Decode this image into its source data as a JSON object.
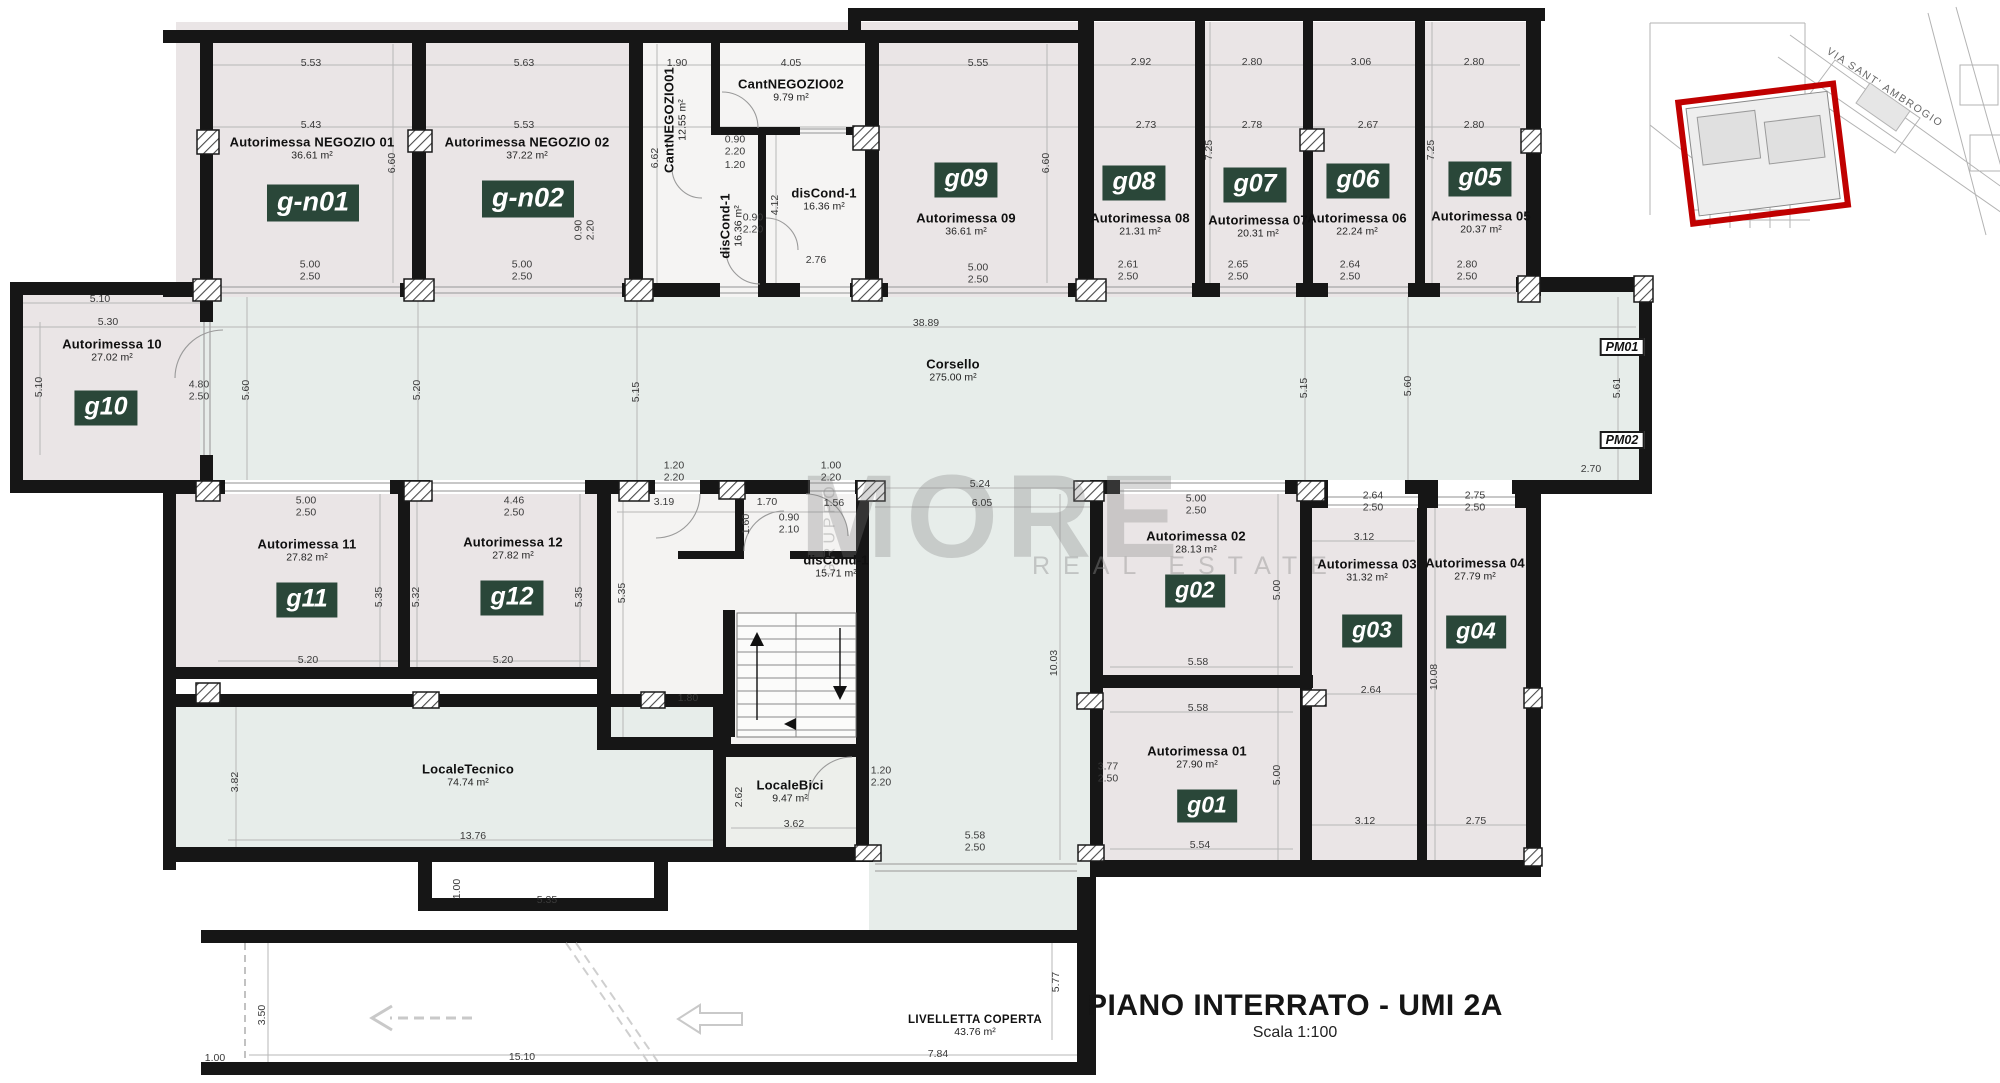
{
  "meta": {
    "title": "PIANO INTERRATO - UMI 2A",
    "scale_label": "Scala 1:100"
  },
  "watermark": {
    "brand": "MORE",
    "sub": "REAL ESTATE",
    "side": "GRUPPO"
  },
  "inset_map": {
    "street_label": "VIA SANT' AMBROGIO"
  },
  "pm_labels": [
    {
      "t": "PM01",
      "x": 1622,
      "y": 347
    },
    {
      "t": "PM02",
      "x": 1622,
      "y": 440
    }
  ],
  "badges": [
    {
      "t": "g-n01",
      "x": 313,
      "y": 203,
      "fs": 27
    },
    {
      "t": "g-n02",
      "x": 528,
      "y": 199,
      "fs": 27
    },
    {
      "t": "g09",
      "x": 966,
      "y": 180,
      "fs": 25
    },
    {
      "t": "g08",
      "x": 1134,
      "y": 183,
      "fs": 25
    },
    {
      "t": "g07",
      "x": 1255,
      "y": 185,
      "fs": 25
    },
    {
      "t": "g06",
      "x": 1358,
      "y": 181,
      "fs": 25
    },
    {
      "t": "g05",
      "x": 1480,
      "y": 179,
      "fs": 25
    },
    {
      "t": "g10",
      "x": 106,
      "y": 408,
      "fs": 25
    },
    {
      "t": "g11",
      "x": 307,
      "y": 600,
      "fs": 25
    },
    {
      "t": "g12",
      "x": 512,
      "y": 598,
      "fs": 25
    },
    {
      "t": "g02",
      "x": 1195,
      "y": 591,
      "fs": 23
    },
    {
      "t": "g03",
      "x": 1372,
      "y": 631,
      "fs": 23
    },
    {
      "t": "g04",
      "x": 1476,
      "y": 632,
      "fs": 23
    },
    {
      "t": "g01",
      "x": 1207,
      "y": 806,
      "fs": 23
    }
  ],
  "rooms": [
    {
      "n": "Autorimessa NEGOZIO 01",
      "a": "36.61 m²",
      "x": 312,
      "y": 148
    },
    {
      "n": "Autorimessa NEGOZIO 02",
      "a": "37.22 m²",
      "x": 527,
      "y": 148
    },
    {
      "n": "CantNEGOZIO01",
      "a": "12.55 m²",
      "x": 675,
      "y": 120,
      "rot": -90
    },
    {
      "n": "CantNEGOZIO02",
      "a": "9.79 m²",
      "x": 791,
      "y": 90
    },
    {
      "n": "disCond-1",
      "a": "16.36 m²",
      "x": 731,
      "y": 226,
      "rot": -90
    },
    {
      "n": "disCond-1",
      "a": "16.36 m²",
      "x": 824,
      "y": 199
    },
    {
      "n": "Autorimessa 09",
      "a": "36.61 m²",
      "x": 966,
      "y": 224
    },
    {
      "n": "Autorimessa 08",
      "a": "21.31 m²",
      "x": 1140,
      "y": 224
    },
    {
      "n": "Autorimessa 07",
      "a": "20.31 m²",
      "x": 1258,
      "y": 226
    },
    {
      "n": "Autorimessa 06",
      "a": "22.24 m²",
      "x": 1357,
      "y": 224
    },
    {
      "n": "Autorimessa 05",
      "a": "20.37 m²",
      "x": 1481,
      "y": 222
    },
    {
      "n": "Autorimessa 10",
      "a": "27.02 m²",
      "x": 112,
      "y": 350
    },
    {
      "n": "Corsello",
      "a": "275.00 m²",
      "x": 953,
      "y": 370
    },
    {
      "n": "Autorimessa 11",
      "a": "27.82 m²",
      "x": 307,
      "y": 550
    },
    {
      "n": "Autorimessa 12",
      "a": "27.82 m²",
      "x": 513,
      "y": 548
    },
    {
      "n": "disCond-1",
      "a": "15.71 m²",
      "x": 836,
      "y": 566
    },
    {
      "n": "Autorimessa 02",
      "a": "28.13 m²",
      "x": 1196,
      "y": 542
    },
    {
      "n": "Autorimessa 03",
      "a": "31.32 m²",
      "x": 1367,
      "y": 570
    },
    {
      "n": "Autorimessa 04",
      "a": "27.79 m²",
      "x": 1475,
      "y": 569
    },
    {
      "n": "Autorimessa 01",
      "a": "27.90 m²",
      "x": 1197,
      "y": 757
    },
    {
      "n": "LocaleTecnico",
      "a": "74.74 m²",
      "x": 468,
      "y": 775
    },
    {
      "n": "LocaleBici",
      "a": "9.47 m²",
      "x": 790,
      "y": 791
    },
    {
      "n": "LIVELLETTA COPERTA",
      "a": "43.76 m²",
      "x": 975,
      "y": 1026,
      "small": true
    }
  ],
  "dims": [
    {
      "t": "5.53",
      "x": 311,
      "y": 64
    },
    {
      "t": "5.63",
      "x": 524,
      "y": 64
    },
    {
      "t": "1.90",
      "x": 677,
      "y": 64
    },
    {
      "t": "4.05",
      "x": 791,
      "y": 64
    },
    {
      "t": "5.55",
      "x": 978,
      "y": 64
    },
    {
      "t": "2.92",
      "x": 1141,
      "y": 63
    },
    {
      "t": "2.80",
      "x": 1252,
      "y": 63
    },
    {
      "t": "3.06",
      "x": 1361,
      "y": 63
    },
    {
      "t": "2.80",
      "x": 1474,
      "y": 63
    },
    {
      "t": "5.43",
      "x": 311,
      "y": 126
    },
    {
      "t": "5.53",
      "x": 524,
      "y": 126
    },
    {
      "t": "2.73",
      "x": 1146,
      "y": 126
    },
    {
      "t": "2.78",
      "x": 1252,
      "y": 126
    },
    {
      "t": "2.67",
      "x": 1368,
      "y": 126
    },
    {
      "t": "2.80",
      "x": 1474,
      "y": 126
    },
    {
      "t": "6.60",
      "x": 393,
      "y": 163,
      "rot": -90
    },
    {
      "t": "6.62",
      "x": 656,
      "y": 158,
      "rot": -90
    },
    {
      "t": "6.60",
      "x": 1047,
      "y": 163,
      "rot": -90
    },
    {
      "t": "7.25",
      "x": 1210,
      "y": 150,
      "rot": -90
    },
    {
      "t": "7.25",
      "x": 1432,
      "y": 150,
      "rot": -90
    },
    {
      "t": "4.12",
      "x": 776,
      "y": 205,
      "rot": -90
    },
    {
      "t": "0.90\n2.20",
      "x": 735,
      "y": 146
    },
    {
      "t": "1.20",
      "x": 735,
      "y": 166
    },
    {
      "t": "0.90\n2.20",
      "x": 753,
      "y": 224
    },
    {
      "t": "2.76",
      "x": 816,
      "y": 261
    },
    {
      "t": "0.90\n2.20",
      "x": 585,
      "y": 230,
      "rot": -90
    },
    {
      "t": "5.00\n2.50",
      "x": 310,
      "y": 271
    },
    {
      "t": "5.00\n2.50",
      "x": 522,
      "y": 271
    },
    {
      "t": "5.00\n2.50",
      "x": 978,
      "y": 274
    },
    {
      "t": "2.61\n2.50",
      "x": 1128,
      "y": 271
    },
    {
      "t": "2.65\n2.50",
      "x": 1238,
      "y": 271
    },
    {
      "t": "2.64\n2.50",
      "x": 1350,
      "y": 271
    },
    {
      "t": "2.80\n2.50",
      "x": 1467,
      "y": 271
    },
    {
      "t": "5.10",
      "x": 100,
      "y": 300
    },
    {
      "t": "5.30",
      "x": 108,
      "y": 323
    },
    {
      "t": "5.10",
      "x": 40,
      "y": 387,
      "rot": -90
    },
    {
      "t": "4.80\n2.50",
      "x": 199,
      "y": 391
    },
    {
      "t": "38.89",
      "x": 926,
      "y": 324
    },
    {
      "t": "5.60",
      "x": 247,
      "y": 390,
      "rot": -90
    },
    {
      "t": "5.20",
      "x": 418,
      "y": 390,
      "rot": -90
    },
    {
      "t": "5.15",
      "x": 637,
      "y": 392,
      "rot": -90
    },
    {
      "t": "5.15",
      "x": 1305,
      "y": 388,
      "rot": -90
    },
    {
      "t": "5.60",
      "x": 1409,
      "y": 386,
      "rot": -90
    },
    {
      "t": "5.61",
      "x": 1618,
      "y": 388,
      "rot": -90
    },
    {
      "t": "2.70",
      "x": 1591,
      "y": 470
    },
    {
      "t": "1.20\n2.20",
      "x": 674,
      "y": 472
    },
    {
      "t": "1.00\n2.20",
      "x": 831,
      "y": 472
    },
    {
      "t": "5.24",
      "x": 980,
      "y": 485
    },
    {
      "t": "6.05",
      "x": 982,
      "y": 504
    },
    {
      "t": "5.00\n2.50",
      "x": 306,
      "y": 507
    },
    {
      "t": "4.46\n2.50",
      "x": 514,
      "y": 507
    },
    {
      "t": "3.19",
      "x": 664,
      "y": 503
    },
    {
      "t": "1.70",
      "x": 767,
      "y": 503
    },
    {
      "t": "1.56",
      "x": 834,
      "y": 504
    },
    {
      "t": "1.60",
      "x": 747,
      "y": 524,
      "rot": -90
    },
    {
      "t": "0.90\n2.10",
      "x": 789,
      "y": 524
    },
    {
      "t": "5.35",
      "x": 380,
      "y": 597,
      "rot": -90
    },
    {
      "t": "5.32",
      "x": 417,
      "y": 597,
      "rot": -90
    },
    {
      "t": "5.35",
      "x": 580,
      "y": 597,
      "rot": -90
    },
    {
      "t": "5.35",
      "x": 623,
      "y": 593,
      "rot": -90
    },
    {
      "t": "5.20",
      "x": 308,
      "y": 661
    },
    {
      "t": "5.20",
      "x": 503,
      "y": 661
    },
    {
      "t": "1.80",
      "x": 688,
      "y": 699
    },
    {
      "t": "5.00\n2.50",
      "x": 1196,
      "y": 505
    },
    {
      "t": "10.03",
      "x": 1055,
      "y": 663,
      "rot": -90
    },
    {
      "t": "5.00",
      "x": 1278,
      "y": 590,
      "rot": -90
    },
    {
      "t": "5.58",
      "x": 1198,
      "y": 663
    },
    {
      "t": "5.58",
      "x": 1198,
      "y": 709
    },
    {
      "t": "3.77\n2.50",
      "x": 1108,
      "y": 773
    },
    {
      "t": "5.00",
      "x": 1278,
      "y": 775,
      "rot": -90
    },
    {
      "t": "5.54",
      "x": 1200,
      "y": 846
    },
    {
      "t": "2.64\n2.50",
      "x": 1373,
      "y": 502
    },
    {
      "t": "2.75\n2.50",
      "x": 1475,
      "y": 502
    },
    {
      "t": "3.12",
      "x": 1364,
      "y": 538
    },
    {
      "t": "2.64",
      "x": 1371,
      "y": 691
    },
    {
      "t": "10.08",
      "x": 1435,
      "y": 677,
      "rot": -90
    },
    {
      "t": "3.12",
      "x": 1365,
      "y": 822
    },
    {
      "t": "2.75",
      "x": 1476,
      "y": 822
    },
    {
      "t": "3.82",
      "x": 236,
      "y": 782,
      "rot": -90
    },
    {
      "t": "13.76",
      "x": 473,
      "y": 837
    },
    {
      "t": "2.62",
      "x": 740,
      "y": 797,
      "rot": -90
    },
    {
      "t": "3.62",
      "x": 794,
      "y": 825
    },
    {
      "t": "1.20\n2.20",
      "x": 881,
      "y": 777
    },
    {
      "t": "5.58\n2.50",
      "x": 975,
      "y": 842
    },
    {
      "t": "1.00",
      "x": 458,
      "y": 889,
      "rot": -90
    },
    {
      "t": "5.35",
      "x": 547,
      "y": 901
    },
    {
      "t": "3.50",
      "x": 263,
      "y": 1015,
      "rot": -90
    },
    {
      "t": "1.00",
      "x": 215,
      "y": 1059
    },
    {
      "t": "15.10",
      "x": 522,
      "y": 1058
    },
    {
      "t": "5.77",
      "x": 1057,
      "y": 982,
      "rot": -90
    },
    {
      "t": "7.84",
      "x": 938,
      "y": 1055
    }
  ]
}
